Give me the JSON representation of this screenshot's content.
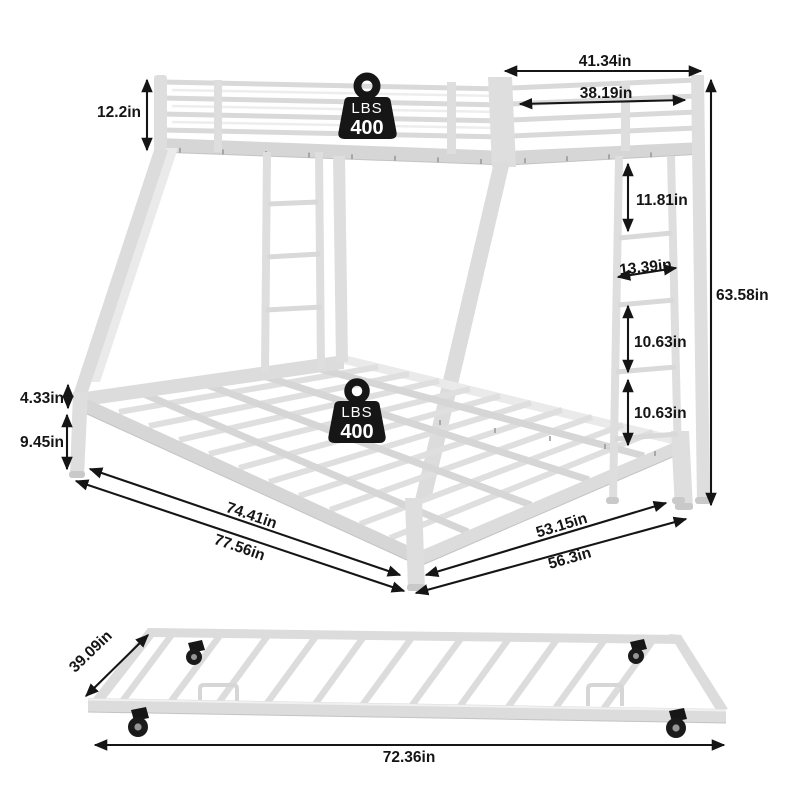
{
  "colors": {
    "background": "#ffffff",
    "frame": "#dcdcdc",
    "annotation": "#151515",
    "badge": "#161616"
  },
  "weight_badges": {
    "top": {
      "unit": "LBS",
      "value": "400"
    },
    "bottom": {
      "unit": "LBS",
      "value": "400"
    }
  },
  "dimensions": {
    "guardrail_height": "12.2in",
    "top_bunk_outer_width": "41.34in",
    "top_bunk_inner_width": "38.19in",
    "overall_height": "63.58in",
    "bunk_gap_height": "11.81in",
    "ladder_width": "13.39in",
    "rung_gap_upper": "10.63in",
    "rung_gap_lower": "10.63in",
    "side_rail_height": "4.33in",
    "underbed_clearance": "9.45in",
    "bottom_bed_inner_length": "74.41in",
    "bottom_bed_outer_length": "77.56in",
    "bottom_bed_inner_width": "53.15in",
    "bottom_bed_outer_width": "56.3in",
    "trundle_width": "39.09in",
    "trundle_length": "72.36in"
  }
}
